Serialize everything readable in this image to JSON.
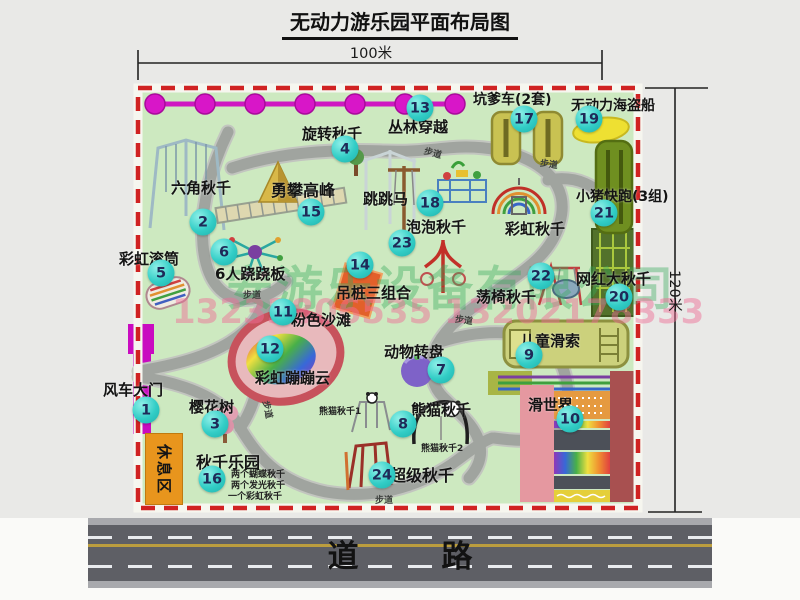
{
  "title": "无动力游乐园平面布局图",
  "dimensions": {
    "horizontal": "100米",
    "vertical": "120米"
  },
  "road_label": "道 路",
  "rest_area_label": "休息区",
  "walkway_label": "步道",
  "watermarks": {
    "company": "安游乐设备有限公司",
    "phone": "13233806535 13202178333"
  },
  "attractions": [
    {
      "num": "1",
      "name": "风车大门"
    },
    {
      "num": "2",
      "name": "六角秋千"
    },
    {
      "num": "3",
      "name": "樱花树"
    },
    {
      "num": "4",
      "name": "旋转秋千"
    },
    {
      "num": "5",
      "name": "彩虹滚筒"
    },
    {
      "num": "6",
      "name": "6人跷跷板"
    },
    {
      "num": "7",
      "name": "动物转盘"
    },
    {
      "num": "8",
      "name": "熊猫秋千",
      "sub": [
        "熊猫秋千1",
        "熊猫秋千2"
      ]
    },
    {
      "num": "9",
      "name": "儿童滑索"
    },
    {
      "num": "10",
      "name": "滑世界"
    },
    {
      "num": "11",
      "name": "粉色沙滩"
    },
    {
      "num": "12",
      "name": "彩虹蹦蹦云"
    },
    {
      "num": "13",
      "name": "丛林穿越"
    },
    {
      "num": "14",
      "name": "吊桩三组合"
    },
    {
      "num": "15",
      "name": "勇攀高峰"
    },
    {
      "num": "16",
      "name": "秋千乐园",
      "sub": [
        "两个蝴蝶秋千",
        "两个发光秋千",
        "一个彩虹秋千"
      ]
    },
    {
      "num": "17",
      "name": "坑爹车(2套)"
    },
    {
      "num": "18",
      "name": "跳跳马"
    },
    {
      "num": "19",
      "name": "无动力海盗船"
    },
    {
      "num": "20",
      "name": "网红大秋千"
    },
    {
      "num": "21",
      "name": "小猪快跑(3组)"
    },
    {
      "num": "22",
      "name": "荡椅秋千"
    },
    {
      "num": "23",
      "name": "泡泡秋千"
    },
    {
      "num": "24",
      "name": "超级秋千"
    },
    {
      "num": "",
      "name": "彩虹秋千",
      "key": "rainbow"
    }
  ]
}
